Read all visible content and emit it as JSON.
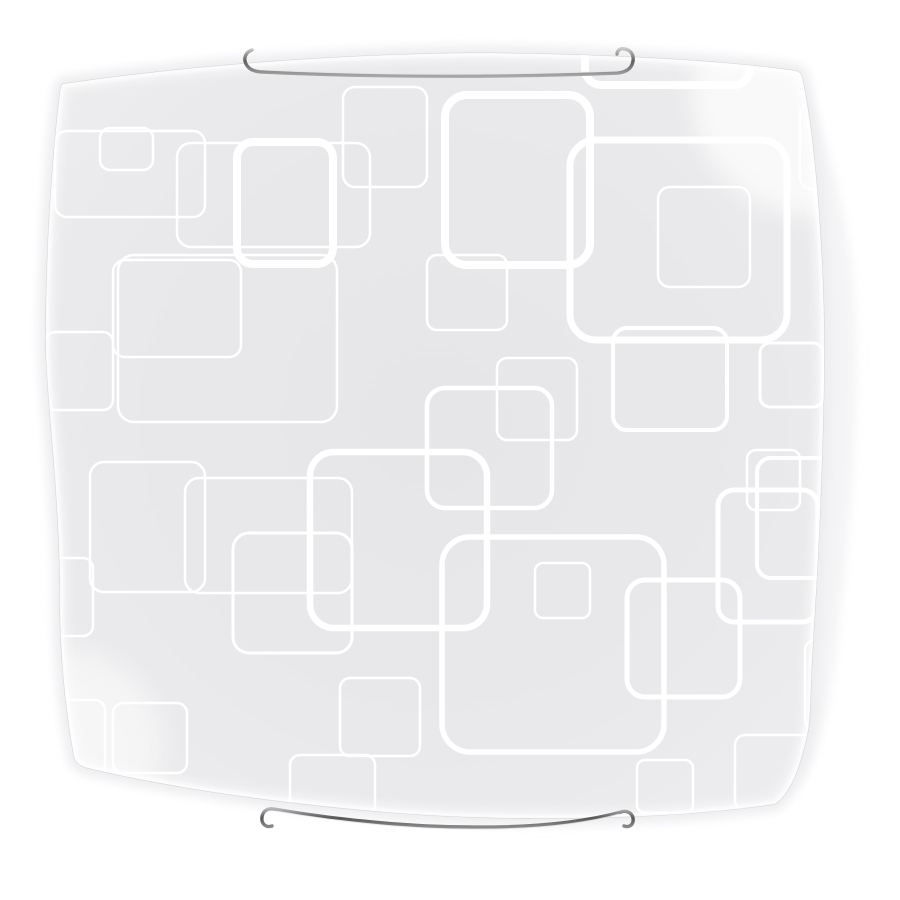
{
  "scene": {
    "description": "Square curved-glass ceiling light fixture with white rounded-square pattern on frosted grey glass, held by two chrome wire clips, on a white background",
    "background_color": "#ffffff"
  },
  "glass": {
    "base_color": "#e8e8ea",
    "center_color": "#e6e6e8",
    "edge_color": "#efeff1",
    "rim_highlight_color": "#ffffff",
    "edge_line_color": "#d4d4d8",
    "side_face_color": "#f4f4f6",
    "pattern_color": "#ffffff"
  },
  "brackets": {
    "chrome_dark": "#5e5e5e",
    "chrome_mid": "#8c8c8c",
    "chrome_light": "#c9c9c9",
    "highlight": "#e6e6e6"
  },
  "pattern_squares": [
    {
      "x": 55,
      "y": 131,
      "w": 150,
      "h": 86,
      "r": 12,
      "sw": 2.5
    },
    {
      "x": 100,
      "y": 128,
      "w": 53,
      "h": 42,
      "r": 10,
      "sw": 2.5
    },
    {
      "x": 177,
      "y": 143,
      "w": 193,
      "h": 104,
      "r": 14,
      "sw": 2.5
    },
    {
      "x": 237,
      "y": 142,
      "w": 96,
      "h": 122,
      "r": 16,
      "sw": 8
    },
    {
      "x": 343,
      "y": 87,
      "w": 84,
      "h": 100,
      "r": 12,
      "sw": 2.5
    },
    {
      "x": 445,
      "y": 95,
      "w": 145,
      "h": 170,
      "r": 22,
      "sw": 8
    },
    {
      "x": 585,
      "y": 22,
      "w": 165,
      "h": 63,
      "r": 16,
      "sw": 8
    },
    {
      "x": 570,
      "y": 140,
      "w": 217,
      "h": 200,
      "r": 26,
      "sw": 7
    },
    {
      "x": 658,
      "y": 187,
      "w": 92,
      "h": 100,
      "r": 12,
      "sw": 2.5
    },
    {
      "x": 800,
      "y": 103,
      "w": 70,
      "h": 86,
      "r": 12,
      "sw": 2.5
    },
    {
      "x": 118,
      "y": 255,
      "w": 219,
      "h": 167,
      "r": 16,
      "sw": 2.5
    },
    {
      "x": 113,
      "y": 260,
      "w": 128,
      "h": 97,
      "r": 12,
      "sw": 2.5
    },
    {
      "x": 45,
      "y": 332,
      "w": 68,
      "h": 78,
      "r": 10,
      "sw": 2.5
    },
    {
      "x": 427,
      "y": 255,
      "w": 80,
      "h": 75,
      "r": 10,
      "sw": 2.5
    },
    {
      "x": 760,
      "y": 343,
      "w": 63,
      "h": 64,
      "r": 10,
      "sw": 3
    },
    {
      "x": 613,
      "y": 328,
      "w": 114,
      "h": 102,
      "r": 14,
      "sw": 4
    },
    {
      "x": 497,
      "y": 358,
      "w": 80,
      "h": 82,
      "r": 10,
      "sw": 2.5
    },
    {
      "x": 427,
      "y": 388,
      "w": 125,
      "h": 120,
      "r": 18,
      "sw": 4.5
    },
    {
      "x": 310,
      "y": 452,
      "w": 177,
      "h": 176,
      "r": 24,
      "sw": 6.5
    },
    {
      "x": 747,
      "y": 450,
      "w": 53,
      "h": 60,
      "r": 9,
      "sw": 2.5
    },
    {
      "x": 757,
      "y": 458,
      "w": 108,
      "h": 120,
      "r": 14,
      "sw": 4
    },
    {
      "x": 718,
      "y": 490,
      "w": 100,
      "h": 132,
      "r": 16,
      "sw": 5
    },
    {
      "x": 90,
      "y": 462,
      "w": 115,
      "h": 130,
      "r": 14,
      "sw": 2.5
    },
    {
      "x": 185,
      "y": 478,
      "w": 167,
      "h": 115,
      "r": 14,
      "sw": 2.5
    },
    {
      "x": 20,
      "y": 558,
      "w": 73,
      "h": 78,
      "r": 10,
      "sw": 2.5
    },
    {
      "x": 233,
      "y": 533,
      "w": 119,
      "h": 120,
      "r": 16,
      "sw": 3
    },
    {
      "x": 442,
      "y": 537,
      "w": 222,
      "h": 215,
      "r": 28,
      "sw": 5.5
    },
    {
      "x": 535,
      "y": 563,
      "w": 55,
      "h": 55,
      "r": 8,
      "sw": 2.5
    },
    {
      "x": 627,
      "y": 580,
      "w": 113,
      "h": 117,
      "r": 18,
      "sw": 5
    },
    {
      "x": 805,
      "y": 640,
      "w": 62,
      "h": 90,
      "r": 10,
      "sw": 2.5
    },
    {
      "x": 35,
      "y": 700,
      "w": 70,
      "h": 80,
      "r": 10,
      "sw": 2.5
    },
    {
      "x": 113,
      "y": 703,
      "w": 74,
      "h": 70,
      "r": 10,
      "sw": 2.5
    },
    {
      "x": 340,
      "y": 678,
      "w": 80,
      "h": 78,
      "r": 10,
      "sw": 2.5
    },
    {
      "x": 637,
      "y": 760,
      "w": 56,
      "h": 53,
      "r": 8,
      "sw": 2.5
    },
    {
      "x": 735,
      "y": 735,
      "w": 85,
      "h": 75,
      "r": 10,
      "sw": 2.5
    },
    {
      "x": 290,
      "y": 755,
      "w": 85,
      "h": 60,
      "r": 10,
      "sw": 2.5
    }
  ]
}
